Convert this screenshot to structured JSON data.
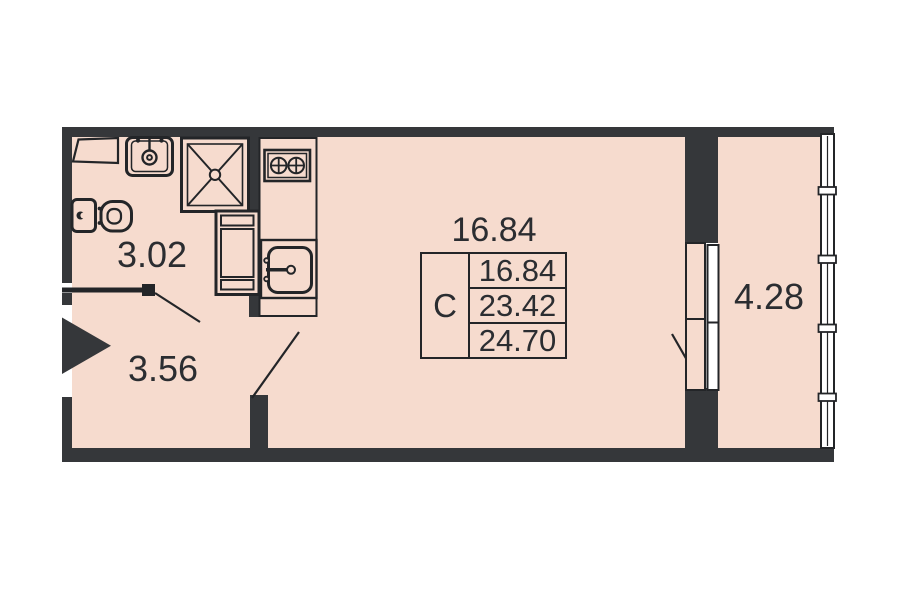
{
  "rooms": {
    "bathroom": {
      "area": "3.02"
    },
    "hallway": {
      "area": "3.56"
    },
    "living": {
      "area": "16.84"
    },
    "balcony": {
      "area": "4.28"
    }
  },
  "legend": {
    "type": "C",
    "rows": [
      "16.84",
      "23.42",
      "24.70"
    ]
  },
  "colors": {
    "floor": "#f6dbce",
    "wall": "#35373a",
    "line": "#232528",
    "text": "#2b2d31",
    "background": "#ffffff"
  }
}
